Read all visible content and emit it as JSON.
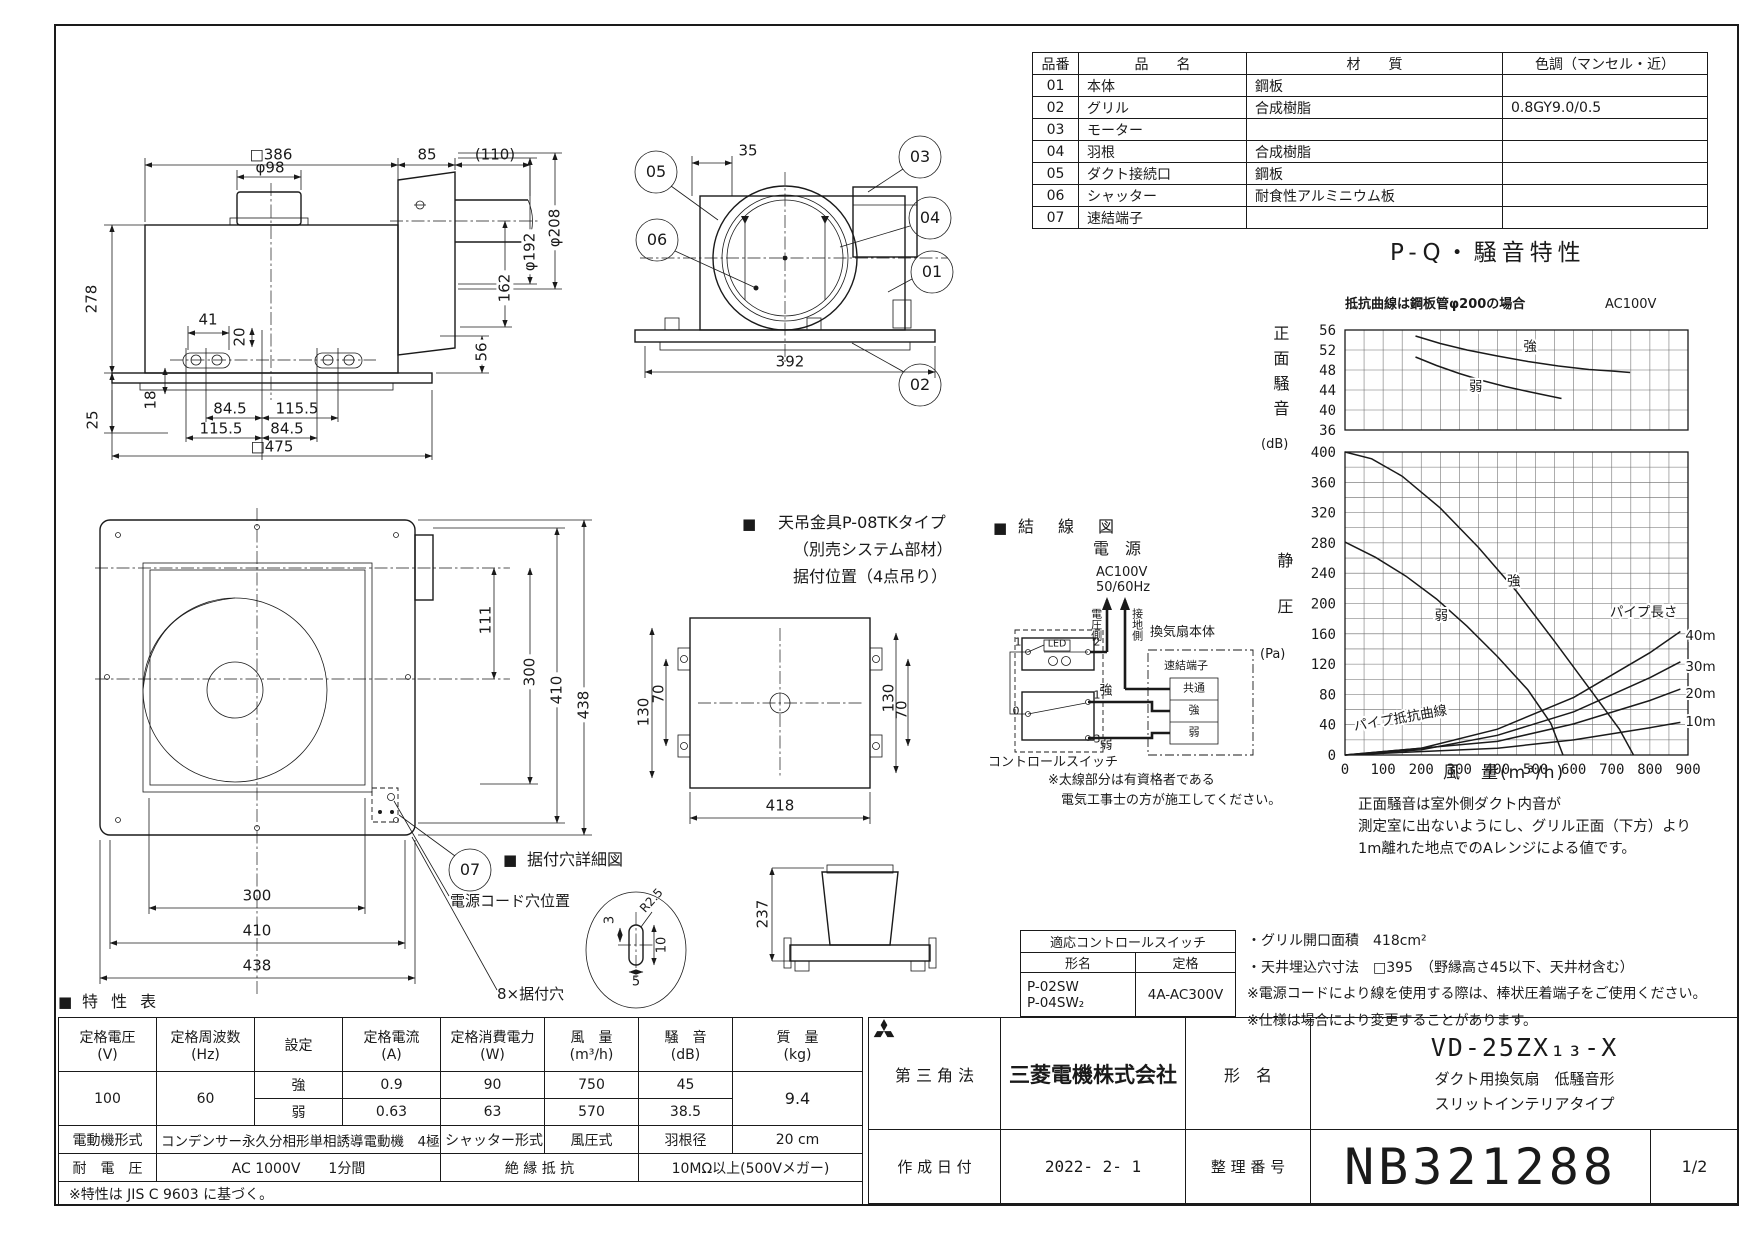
{
  "colors": {
    "ink": "#1a1a1a",
    "paper": "#ffffff"
  },
  "parts_table": {
    "headers": [
      "品番",
      "品　　名",
      "材　　質",
      "色調（マンセル・近）"
    ],
    "rows": [
      [
        "01",
        "本体",
        "鋼板",
        ""
      ],
      [
        "02",
        "グリル",
        "合成樹脂",
        "0.8GY9.0/0.5"
      ],
      [
        "03",
        "モーター",
        "",
        ""
      ],
      [
        "04",
        "羽根",
        "合成樹脂",
        ""
      ],
      [
        "05",
        "ダクト接続口",
        "鋼板",
        ""
      ],
      [
        "06",
        "シャッター",
        "耐食性アルミニウム板",
        ""
      ],
      [
        "07",
        "速結端子",
        "",
        ""
      ]
    ]
  },
  "front": {
    "dims": {
      "w386": "□386",
      "w85": "85",
      "w110": "(110)",
      "phi98": "φ98",
      "h278": "278",
      "h25": "25",
      "h18": "18",
      "w41": "41",
      "h20": "20",
      "phi192": "φ192",
      "phi208": "φ208",
      "h162": "162",
      "h56": "56",
      "p1a": "84.5",
      "p1b": "115.5",
      "p2a": "115.5",
      "p2b": "84.5",
      "w475": "□475"
    }
  },
  "side": {
    "dims": {
      "d35": "35",
      "d392": "392"
    },
    "balloons": {
      "b05": "05",
      "b06": "06",
      "b03": "03",
      "b04": "04",
      "b01": "01",
      "b02": "02"
    }
  },
  "bottom": {
    "dims": {
      "d111": "111",
      "v300": "300",
      "v410": "410",
      "v438": "438",
      "h300": "300",
      "h410": "410",
      "h438": "438"
    },
    "balloon07": "07",
    "cord_label": "電源コード穴位置",
    "holes_label": "8×据付穴",
    "detail": {
      "marker": "■",
      "title": "据付穴詳細図",
      "d3": "3",
      "r": "R2.5",
      "d10": "10",
      "d5": "5"
    }
  },
  "bracket": {
    "marker": "■",
    "line1": "天吊金具P-08TKタイプ",
    "line2": "（別売システム部材）",
    "line3": "据付位置（4点吊り）",
    "dims": {
      "l70": "70",
      "l130": "130",
      "r130": "130",
      "r70": "70",
      "w418": "418",
      "h237": "237"
    }
  },
  "wiring": {
    "marker": "■",
    "title": "結　線　図",
    "power": "電　源",
    "voltage": "AC100V",
    "freq": "50/60Hz",
    "hot_side": "電圧側",
    "ground_side": "接地側",
    "fan_body": "換気扇本体",
    "terminal": "速結端子",
    "t_common": "共通",
    "t_high": "強",
    "t_low": "弱",
    "led": "LED",
    "wire_high": "強",
    "wire_low": "弱",
    "control": "コントロールスイッチ",
    "n0": "0",
    "n1": "1",
    "n2": "2",
    "n3": "3",
    "n1b": "1",
    "note1": "※太線部分は有資格者である",
    "note2": "電気工事士の方が施工してください。"
  },
  "pq": {
    "title": "P-Q・騒音特性",
    "note_left": "抵抗曲線は鋼板管φ200の場合",
    "note_right": "AC100V",
    "noise_axis": "正面騒音",
    "noise_unit": "(dB)",
    "pressure_axis": "静圧",
    "pressure_unit": "(Pa)",
    "xlabel": "風　量(m³/h)",
    "footnote1": "正面騒音は室外側ダクト内音が",
    "footnote2": "測定室に出ないようにし、グリル正面（下方）より",
    "footnote3": "1m離れた地点でのAレンジによる値です。"
  },
  "chart_data": [
    {
      "type": "line",
      "plot": "front-noise",
      "ylabel": "正面騒音 (dB)",
      "xlim": [
        0,
        900
      ],
      "ylim": [
        36,
        56
      ],
      "yticks": [
        36,
        40,
        44,
        48,
        52,
        56
      ],
      "grid_x_step": 50,
      "grid_y_step": 4,
      "series": [
        {
          "name": "強",
          "points": [
            [
              185,
              54.8
            ],
            [
              250,
              53.3
            ],
            [
              320,
              52.0
            ],
            [
              400,
              50.8
            ],
            [
              480,
              49.7
            ],
            [
              560,
              48.8
            ],
            [
              640,
              48.1
            ],
            [
              700,
              47.8
            ],
            [
              748,
              47.5
            ]
          ],
          "label_at": [
            468,
            51.8
          ]
        },
        {
          "name": "弱",
          "points": [
            [
              185,
              50.6
            ],
            [
              240,
              48.9
            ],
            [
              300,
              47.3
            ],
            [
              360,
              45.9
            ],
            [
              420,
              44.7
            ],
            [
              480,
              43.7
            ],
            [
              530,
              42.9
            ],
            [
              568,
              42.3
            ]
          ],
          "label_at": [
            325,
            43.8
          ]
        }
      ]
    },
    {
      "type": "line",
      "plot": "static-pressure",
      "ylabel": "静圧 (Pa)",
      "xlabel": "風量(m³/h)",
      "xlim": [
        0,
        900
      ],
      "ylim": [
        0,
        400
      ],
      "yticks": [
        0,
        40,
        80,
        120,
        160,
        200,
        240,
        280,
        320,
        360,
        400
      ],
      "xticks": [
        0,
        100,
        200,
        300,
        400,
        500,
        600,
        700,
        800,
        900
      ],
      "grid_x_step": 50,
      "grid_y_step": 20,
      "series": [
        {
          "name": "強",
          "points": [
            [
              0,
              400
            ],
            [
              70,
              391
            ],
            [
              150,
              368
            ],
            [
              250,
              326
            ],
            [
              350,
              274
            ],
            [
              450,
              216
            ],
            [
              550,
              150
            ],
            [
              650,
              82
            ],
            [
              720,
              34
            ],
            [
              757,
              0
            ]
          ],
          "label_at": [
            425,
            224
          ]
        },
        {
          "name": "弱",
          "points": [
            [
              0,
              281
            ],
            [
              80,
              261
            ],
            [
              160,
              236
            ],
            [
              240,
              206
            ],
            [
              320,
              170
            ],
            [
              400,
              130
            ],
            [
              480,
              86
            ],
            [
              540,
              42
            ],
            [
              572,
              0
            ]
          ],
          "label_at": [
            235,
            178
          ]
        },
        {
          "name": "40m",
          "points": [
            [
              0,
              0
            ],
            [
              200,
              9
            ],
            [
              400,
              34
            ],
            [
              600,
              76
            ],
            [
              800,
              135
            ],
            [
              880,
              163
            ]
          ],
          "label_at": [
            893,
            152
          ]
        },
        {
          "name": "30m",
          "points": [
            [
              0,
              0
            ],
            [
              200,
              7
            ],
            [
              400,
              26
            ],
            [
              600,
              57
            ],
            [
              800,
              102
            ],
            [
              880,
              123
            ]
          ],
          "label_at": [
            893,
            111
          ]
        },
        {
          "name": "20m",
          "points": [
            [
              0,
              0
            ],
            [
              400,
              18
            ],
            [
              600,
              41
            ],
            [
              800,
              72
            ],
            [
              880,
              87
            ]
          ],
          "label_at": [
            893,
            75
          ]
        },
        {
          "name": "10m",
          "points": [
            [
              0,
              0
            ],
            [
              400,
              9
            ],
            [
              600,
              20
            ],
            [
              800,
              36
            ],
            [
              880,
              43
            ]
          ],
          "label_at": [
            893,
            38
          ]
        }
      ],
      "annotations": [
        {
          "text": "パイプ長さ",
          "x": 695,
          "y": 183
        },
        {
          "text": "パイプ抵抗曲線",
          "x": 25,
          "y": 32,
          "rot": -10
        }
      ]
    }
  ],
  "switch_table": {
    "title": "適応コントロールスイッチ",
    "col1": "形名",
    "col2": "定格",
    "model1": "P-02SW",
    "model2": "P-04SW₂",
    "rating": "4A-AC300V"
  },
  "notes": {
    "n1": "・グリル開口面積　418cm²",
    "n2": "・天井埋込穴寸法　□395　（野縁高さ45以下、天井材含む）",
    "n3": "※電源コードにより線を使用する際は、棒状圧着端子をご使用ください。",
    "n4": "※仕様は場合により変更することがあります。"
  },
  "spec": {
    "section_marker": "■",
    "section_title": "特 性 表",
    "headers": {
      "voltage": [
        "定格電圧",
        "(V)"
      ],
      "freq": [
        "定格周波数",
        "(Hz)"
      ],
      "setting": [
        "設定",
        ""
      ],
      "current": [
        "定格電流",
        "(A)"
      ],
      "power": [
        "定格消費電力",
        "(W)"
      ],
      "airflow": [
        "風　量",
        "(m³/h)"
      ],
      "noise": [
        "騒　音",
        "(dB)"
      ],
      "mass": [
        "質　量",
        "(kg)"
      ]
    },
    "voltage": "100",
    "freq": "60",
    "mode_high": "強",
    "mode_low": "弱",
    "current_high": "0.9",
    "current_low": "0.63",
    "power_high": "90",
    "power_low": "63",
    "airflow_high": "750",
    "airflow_low": "570",
    "noise_high": "45",
    "noise_low": "38.5",
    "mass": "9.4",
    "motor_label": "電動機形式",
    "motor_value": "コンデンサー永久分相形単相誘導電動機　4極",
    "shutter_label": "シャッター形式",
    "shutter_value": "風圧式",
    "blade_label": "羽根径",
    "blade_value": "20 cm",
    "withstand_label": "耐　電　圧",
    "withstand_value": "AC 1000V　　1分間",
    "insulation_label": "絶 縁 抵 抗",
    "insulation_value": "10MΩ以上(500Vメガー)",
    "footnote": "※特性は JIS C 9603 に基づく。"
  },
  "title_block": {
    "projection": "第 三 角 法",
    "company": "三菱電機株式会社",
    "model_label": "形　名",
    "model": "VD-25ZX₁₃-X",
    "model_sub1": "ダクト用換気扇　低騒音形",
    "model_sub2": "スリットインテリアタイプ",
    "date_label": "作 成 日 付",
    "date": "2022- 2- 1",
    "doc_label": "整 理 番 号",
    "doc_number": "NB321288",
    "sheet": "1/2"
  }
}
